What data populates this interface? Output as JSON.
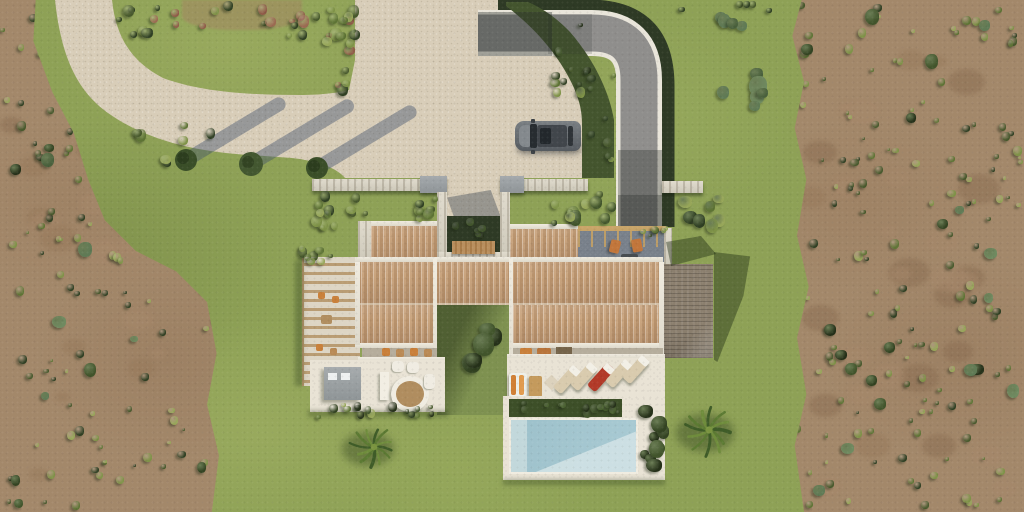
{
  "scene": {
    "name": "aerial-villa-3d-render",
    "width": 1024,
    "height": 512,
    "description_elements": [
      "lawn",
      "olive-scrubland",
      "gravel-driveway",
      "curved-asphalt-road",
      "parked-car",
      "villa-terracotta-roof",
      "entrance-courtyard",
      "rooftop-terrace",
      "pergola",
      "outdoor-kitchen",
      "dining-terrace",
      "sun-lounger-terrace",
      "swimming-pool",
      "palm-trees",
      "tree-shadows"
    ]
  },
  "palette": {
    "grass": "#8ea156",
    "scrub": "#a3886a",
    "gravel": "#d8cdb8",
    "asphalt": "#8f8e8c",
    "curb": "#e9e5da",
    "hedge": "#2e3a25",
    "roof-tile": "#c9a47e",
    "roof-gray": "#8b7f6e",
    "terrace": "#e9e3d5",
    "porch-shade": "#b5ad9c",
    "deck": "#78808a",
    "stone": "#d8d3c5",
    "pool": "#a5c7d0",
    "pool-light": "#cfe1e4",
    "pool-steps": "#c2d8db",
    "car-body": "#5f646a",
    "car-roof": "#41464b",
    "car-glass": "#23282c",
    "wood": "#b08d5f",
    "accent-orange": "#c9803a",
    "lounger-tan": "#d9cbae",
    "lounger-red": "#b23a28",
    "kitchen-gray": "#9ba1a3",
    "shadow-blue": "rgba(62,78,108,0.42)",
    "shadow-green": "rgba(28,42,16,0.42)"
  },
  "bush_palettes": {
    "greens": [
      "#2f3f23",
      "#47582c",
      "#5d7334",
      "#7e9247",
      "#97a659"
    ],
    "blue_greens": [
      "#5f7a55",
      "#49603c",
      "#6f8a60"
    ],
    "dark_hedge": [
      "#253019",
      "#334322",
      "#41542b"
    ],
    "reddish": [
      "#8f5a48",
      "#9b6a52"
    ],
    "dirt": [
      "#96795b",
      "#8a6d52",
      "#a5876a"
    ]
  },
  "villa": {
    "pool_loungers": [
      "tan",
      "tan",
      "red",
      "tan",
      "tan"
    ],
    "rooftop_chairs": 2,
    "palm_trees": 2,
    "driveway_trees": 3,
    "pergola_chairs": 4
  },
  "car": {
    "type": "suv",
    "color": "#5f646a",
    "heading": "west"
  }
}
